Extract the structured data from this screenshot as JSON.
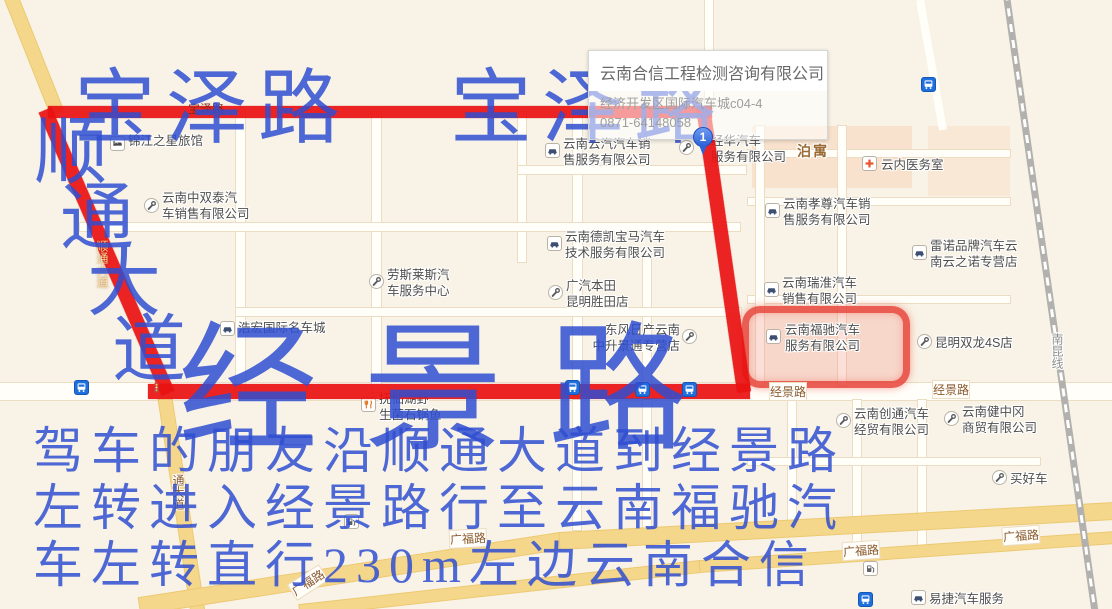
{
  "colors": {
    "route_red": "#e91212",
    "annotation_blue": "#2f4dd0",
    "highlight_red": "#e73e34",
    "road_yellow": "#f5d78b",
    "bus_blue": "#1f6fdd",
    "map_bg": "#f8f3e6"
  },
  "tooltip": {
    "title": "云南合信工程检测咨询有限公司",
    "address": "经济开发区国际汽车城c04-4",
    "phone": "0871-64148058"
  },
  "marker": {
    "label": "1",
    "x": 693,
    "y": 127
  },
  "annotations": {
    "big_roads": [
      {
        "name": "baoze-road-left",
        "text": "宝泽路",
        "x": 74,
        "y": 68,
        "size": 82,
        "ls": 10
      },
      {
        "name": "baoze-road-right",
        "text": "宝泽路",
        "x": 450,
        "y": 68,
        "size": 82,
        "ls": 10
      },
      {
        "name": "jingjing-road-big",
        "text": "经景路",
        "x": 178,
        "y": 322,
        "size": 140,
        "ls": 45
      }
    ],
    "vertical_road": {
      "name": "shuntong-avenue",
      "size": 74,
      "chars": [
        {
          "ch": "顺",
          "x": 34,
          "y": 116
        },
        {
          "ch": "通",
          "x": 60,
          "y": 182
        },
        {
          "ch": "大",
          "x": 87,
          "y": 248
        },
        {
          "ch": "道",
          "x": 112,
          "y": 314
        }
      ]
    },
    "directions": {
      "x": 33,
      "y": 426,
      "size": 50,
      "line_h": 57,
      "lines": [
        "驾车的朋友沿顺通大道到经景路",
        "左转进入经景路行至云南福驰汽",
        "车左转直行230m左边云南合信"
      ]
    }
  },
  "pois": [
    {
      "name": "jinjiang-inn",
      "icon": "hotel-icon",
      "ix": 110,
      "iy": 136,
      "label": {
        "x": 128,
        "y": 133,
        "lines": [
          "锦江之星旅馆"
        ]
      }
    },
    {
      "name": "zhongshuangtai-auto",
      "icon": "wrench-icon",
      "ix": 144,
      "iy": 198,
      "label": {
        "x": 162,
        "y": 190,
        "lines": [
          "云南中双泰汽",
          "车销售有限公司"
        ]
      }
    },
    {
      "name": "yunqi-auto",
      "icon": "car-icon",
      "ix": 545,
      "iy": 143,
      "label": {
        "x": 563,
        "y": 136,
        "lines": [
          "云南云汽汽车销",
          "售服务有限公司"
        ]
      }
    },
    {
      "name": "jinghua-auto",
      "icon": "wrench-icon",
      "ix": 679,
      "iy": 140,
      "label": {
        "x": 711,
        "y": 133,
        "lines": [
          "经华汽车",
          "服务有限公司"
        ]
      }
    },
    {
      "name": "dekai-bmw",
      "icon": "car-icon",
      "ix": 547,
      "iy": 236,
      "label": {
        "x": 565,
        "y": 229,
        "lines": [
          "云南德凯宝马汽车",
          "技术服务有限公司"
        ]
      }
    },
    {
      "name": "rolls-royce-service",
      "icon": "wrench-icon",
      "ix": 369,
      "iy": 274,
      "label": {
        "x": 387,
        "y": 267,
        "lines": [
          "劳斯莱斯汽",
          "车服务中心"
        ]
      }
    },
    {
      "name": "haohong-auto-mall",
      "icon": "car-icon",
      "ix": 220,
      "iy": 321,
      "label": {
        "x": 238,
        "y": 320,
        "lines": [
          "浩宏国际名车城"
        ]
      }
    },
    {
      "name": "gac-honda",
      "icon": "wrench-icon",
      "ix": 548,
      "iy": 285,
      "label": {
        "x": 566,
        "y": 278,
        "lines": [
          "广汽本田",
          "昆明胜田店"
        ]
      }
    },
    {
      "name": "dongfeng-nissan",
      "icon": "wrench-icon",
      "ix": 682,
      "iy": 329,
      "label": {
        "x": 592,
        "y": 322,
        "w": 88,
        "align": "right",
        "lines": [
          "东风日产云南",
          "中升景通专营店"
        ]
      }
    },
    {
      "name": "yunnei-clinic",
      "icon": "cross-icon",
      "ix": 862,
      "iy": 156,
      "label": {
        "x": 881,
        "y": 157,
        "lines": [
          "云内医务室"
        ]
      }
    },
    {
      "name": "xiaozun-auto",
      "icon": "car-icon",
      "ix": 765,
      "iy": 203,
      "label": {
        "x": 783,
        "y": 196,
        "lines": [
          "云南孝尊汽车销",
          "售服务有限公司"
        ]
      }
    },
    {
      "name": "renault-store",
      "icon": "car-icon",
      "ix": 912,
      "iy": 245,
      "label": {
        "x": 930,
        "y": 238,
        "lines": [
          "雷诺品牌汽车云",
          "南云之诺专营店"
        ]
      }
    },
    {
      "name": "ruihuai-auto",
      "icon": "car-icon",
      "ix": 764,
      "iy": 282,
      "label": {
        "x": 782,
        "y": 275,
        "lines": [
          "云南瑞淮汽车",
          "销售有限公司"
        ]
      }
    },
    {
      "name": "fuchi-auto",
      "icon": "car-icon",
      "ix": 766,
      "iy": 329,
      "label": {
        "x": 785,
        "y": 322,
        "lines": [
          "云南福驰汽车",
          "服务有限公司"
        ]
      }
    },
    {
      "name": "shuanglong-4s",
      "icon": "wrench-icon",
      "ix": 917,
      "iy": 334,
      "label": {
        "x": 935,
        "y": 335,
        "lines": [
          "昆明双龙4S店"
        ]
      }
    },
    {
      "name": "fuxianhu-restaurant",
      "icon": "fork-icon",
      "ix": 361,
      "iy": 397,
      "label": {
        "x": 379,
        "y": 391,
        "lines": [
          "抚仙湖野",
          "生菌石锅鱼"
        ]
      }
    },
    {
      "name": "chuangtong-auto",
      "icon": "wrench-icon",
      "ix": 836,
      "iy": 413,
      "label": {
        "x": 854,
        "y": 406,
        "lines": [
          "云南创通汽车",
          "经贸有限公司"
        ]
      }
    },
    {
      "name": "jianzhonggang-trade",
      "icon": "wrench-icon",
      "ix": 944,
      "iy": 411,
      "label": {
        "x": 962,
        "y": 404,
        "lines": [
          "云南健中冈",
          "商贸有限公司"
        ]
      }
    },
    {
      "name": "maihaoche",
      "icon": "wrench-icon",
      "ix": 992,
      "iy": 470,
      "label": {
        "x": 1010,
        "y": 471,
        "lines": [
          "买好车"
        ]
      }
    },
    {
      "name": "yijie-auto-service",
      "icon": "car-icon",
      "ix": 911,
      "iy": 590,
      "label": {
        "x": 929,
        "y": 591,
        "lines": [
          "易捷汽车服务"
        ]
      }
    }
  ],
  "road_labels": [
    {
      "text": "经景路",
      "x": 770,
      "y": 383,
      "style": "road"
    },
    {
      "text": "经景路",
      "x": 933,
      "y": 381,
      "style": "road"
    },
    {
      "text": "广福路",
      "x": 450,
      "y": 530,
      "style": "road",
      "rot": -3
    },
    {
      "text": "广福路",
      "x": 843,
      "y": 542,
      "style": "road",
      "rot": -4
    },
    {
      "text": "广福路",
      "x": 1003,
      "y": 527,
      "style": "road",
      "rot": -4
    },
    {
      "text": "广福路",
      "x": 290,
      "y": 574,
      "style": "road",
      "rot": -33
    },
    {
      "text": "通大道",
      "x": 170,
      "y": 474,
      "style": "road-vert"
    },
    {
      "text": "南昆线",
      "x": 1049,
      "y": 333,
      "style": "rail-vert"
    },
    {
      "text": "泊寓",
      "x": 797,
      "y": 141,
      "style": "area"
    },
    {
      "text": "宝泽路",
      "x": 188,
      "y": 100,
      "style": "on-red"
    },
    {
      "text": "顺通大道",
      "x": 94,
      "y": 240,
      "style": "on-red-vert"
    }
  ],
  "transit": [
    {
      "icon": "bus-icon",
      "x": 921,
      "y": 77
    },
    {
      "icon": "bus-icon",
      "x": 74,
      "y": 380
    },
    {
      "icon": "bus-icon",
      "x": 565,
      "y": 380,
      "onred": true
    },
    {
      "icon": "bus-icon",
      "x": 635,
      "y": 382,
      "onred": true
    },
    {
      "icon": "bus-icon",
      "x": 682,
      "y": 382,
      "onred": true
    },
    {
      "icon": "bus-icon",
      "x": 858,
      "y": 592
    },
    {
      "icon": "gas-icon",
      "x": 863,
      "y": 561
    },
    {
      "icon": "gas-icon",
      "x": 344,
      "y": 514
    },
    {
      "icon": "traffic-light-icon",
      "x": 150,
      "y": 381,
      "onred": true
    }
  ],
  "highlight_box": {
    "x": 742,
    "y": 306,
    "w": 154,
    "h": 68
  }
}
